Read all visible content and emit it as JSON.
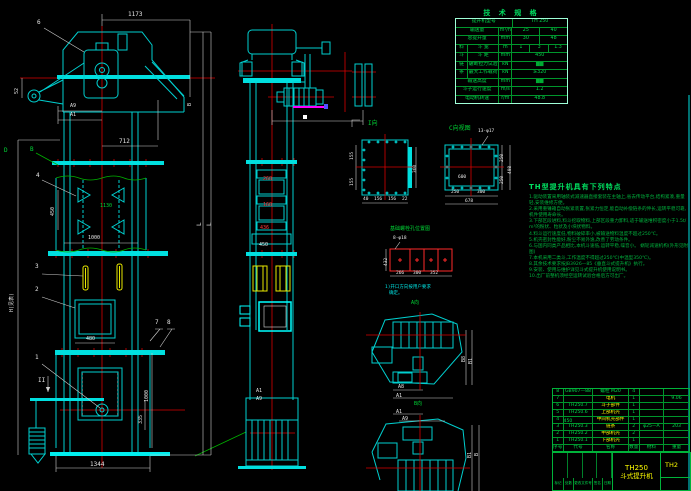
{
  "drawing": {
    "canvas_kind": "CAD model space (bucket elevator assembly drawing)",
    "accent_colors": {
      "geometry": "#00cfcf",
      "dimension": "#e6e6e6",
      "centerline": "#e80000",
      "table": "#00d936",
      "highlight": "#ffff00",
      "flag": "#ff00ff"
    }
  },
  "spec_table": {
    "title": "技 术 规 格",
    "rows": [
      {
        "c": [
          {
            "t": "提升机型号",
            "w": 50
          },
          {
            "t": "TH 250",
            "w": 50
          }
        ]
      },
      {
        "c": [
          {
            "t": "输送量",
            "w": 38
          },
          {
            "t": "m³/h",
            "w": 12
          },
          {
            "t": "25",
            "w": 25
          },
          {
            "t": "40",
            "w": 25
          }
        ]
      },
      {
        "c": [
          {
            "t": "总提升量",
            "w": 38
          },
          {
            "t": "mm",
            "w": 12
          },
          {
            "t": "30",
            "w": 25
          },
          {
            "t": "48",
            "w": 25
          }
        ]
      },
      {
        "c": [
          {
            "t": "料",
            "w": 10
          },
          {
            "t": "斗 宽",
            "w": 28
          },
          {
            "t": "m",
            "w": 12
          },
          {
            "t": "1",
            "w": 16
          },
          {
            "t": "3",
            "w": 17
          },
          {
            "t": "1.3",
            "w": 17
          }
        ]
      },
      {
        "c": [
          {
            "t": "斗",
            "w": 10
          },
          {
            "t": "斗 距",
            "w": 28
          },
          {
            "t": "mm",
            "w": 12
          },
          {
            "t": "450",
            "w": 50
          }
        ]
      },
      {
        "c": [
          {
            "t": "链",
            "w": 10
          },
          {
            "t": "破断拉力试验",
            "w": 28
          },
          {
            "t": "kN",
            "w": 12
          },
          {
            "t": "▇▇",
            "w": 50,
            "cls": "dark"
          }
        ]
      },
      {
        "c": [
          {
            "t": "条",
            "w": 10
          },
          {
            "t": "最大工作载荷",
            "w": 28
          },
          {
            "t": "kN",
            "w": 12
          },
          {
            "t": "≥320",
            "w": 50
          }
        ]
      },
      {
        "c": [
          {
            "t": "输送高度",
            "w": 38
          },
          {
            "t": "mm",
            "w": 12
          },
          {
            "t": "▇▇",
            "w": 50,
            "cls": "dark"
          }
        ]
      },
      {
        "c": [
          {
            "t": "斗子运行速度",
            "w": 38
          },
          {
            "t": "m/s",
            "w": 12
          },
          {
            "t": "1.2",
            "w": 50
          }
        ]
      },
      {
        "c": [
          {
            "t": "电动机转速",
            "w": 38
          },
          {
            "t": "r/m",
            "w": 12
          },
          {
            "t": "48.8",
            "w": 50
          }
        ]
      }
    ]
  },
  "notes": {
    "title": "TH型提升机具有下列特点",
    "lines": [
      "1.驱动装置采用轴装式减速器直接套装在主轴上,省去传动平台,结构紧凑,重量轻,安装维修方便。",
      "2.采用重锤箱自动张紧装置,张紧力恒定,能自动补偿链条的伸长,运转平稳可靠,机件使用寿命长。",
      "3.下部区段进料,料斗挖取物料,上部区段重力卸料,适于输送堆积密度小于1.5t/m³的粉状、粒状及小块状物料。",
      "4.料斗运行速度低,物料破碎率小,被输送物料温度不超过250℃。",
      "5.机壳密封性能好,粉尘不易外逸,改善了劳动条件。",
      "6.与国内同类产品相比,本机斗速低,运转平稳,噪音小。  蜗轮减速机构(外形见附图)",
      "7.本机采用二类斗,工作温度不得超过250℃(中温型350℃)。",
      "8.其余技术要求按JB3926—85《垂直斗式提升机》执行。",
      "9.安装、使用与维护详见斗式提升机使用说明书。",
      "10.出厂前整机须经空运转试验合格后方可出厂。"
    ]
  },
  "bom": {
    "rows": [
      {
        "c": [
          {
            "t": "8",
            "w": 7
          },
          {
            "t": "GB907—88",
            "w": 22
          },
          {
            "t": "螺栓 M20",
            "w": 26
          },
          {
            "t": "4",
            "w": 8
          },
          {
            "t": "",
            "w": 18
          },
          {
            "t": "",
            "w": 19
          }
        ]
      },
      {
        "c": [
          {
            "t": "7",
            "w": 7
          },
          {
            "t": "",
            "w": 22
          },
          {
            "t": "电机",
            "w": 26,
            "cls": "y"
          },
          {
            "t": "1",
            "w": 8
          },
          {
            "t": "",
            "w": 18
          },
          {
            "t": "9.06",
            "w": 19
          }
        ]
      },
      {
        "c": [
          {
            "t": "6",
            "w": 7
          },
          {
            "t": "TH250.7",
            "w": 22
          },
          {
            "t": "斗子部件",
            "w": 26,
            "cls": "y"
          },
          {
            "t": "1",
            "w": 8
          },
          {
            "t": "",
            "w": 18
          },
          {
            "t": "",
            "w": 19
          }
        ]
      },
      {
        "c": [
          {
            "t": "5",
            "w": 7
          },
          {
            "t": "TH250.6",
            "w": 22
          },
          {
            "t": "上部机壳",
            "w": 26,
            "cls": "y"
          },
          {
            "t": "1",
            "w": 8
          },
          {
            "t": "",
            "w": 18
          },
          {
            "t": "",
            "w": 19
          }
        ]
      },
      {
        "c": [
          {
            "t": "4",
            "w": 7
          },
          {
            "t": "TH250.4-450",
            "w": 22
          },
          {
            "t": "中间机壳部件",
            "w": 26,
            "cls": "y"
          },
          {
            "t": "1",
            "w": 8
          },
          {
            "t": "",
            "w": 18
          },
          {
            "t": "",
            "w": 19
          }
        ]
      },
      {
        "c": [
          {
            "t": "3",
            "w": 7
          },
          {
            "t": "TH250.3",
            "w": 22
          },
          {
            "t": "链条",
            "w": 26,
            "cls": "y"
          },
          {
            "t": "2",
            "w": 8
          },
          {
            "t": "φ25—A",
            "w": 18
          },
          {
            "t": "203",
            "w": 19
          }
        ]
      },
      {
        "c": [
          {
            "t": "2",
            "w": 7
          },
          {
            "t": "TH250.2",
            "w": 22
          },
          {
            "t": "中部机壳",
            "w": 26,
            "cls": "y"
          },
          {
            "t": "2",
            "w": 8
          },
          {
            "t": "",
            "w": 18
          },
          {
            "t": "",
            "w": 19
          }
        ]
      },
      {
        "c": [
          {
            "t": "1",
            "w": 7
          },
          {
            "t": "TH250.1",
            "w": 22
          },
          {
            "t": "下部机壳",
            "w": 26,
            "cls": "y"
          },
          {
            "t": "1",
            "w": 8
          },
          {
            "t": "",
            "w": 18
          },
          {
            "t": "",
            "w": 19
          }
        ]
      },
      {
        "c": [
          {
            "t": "序号",
            "w": 7
          },
          {
            "t": "代号",
            "w": 22
          },
          {
            "t": "名称",
            "w": 26
          },
          {
            "t": "数量",
            "w": 8
          },
          {
            "t": "材料",
            "w": 18
          },
          {
            "t": "重量",
            "w": 19
          }
        ]
      }
    ]
  },
  "title_block": {
    "model": "TH250",
    "product": "斗式提升机",
    "drawing_no": "TH2",
    "field_rows": [
      {
        "c": [
          {
            "t": "标记",
            "w": 17
          },
          {
            "t": "处数",
            "w": 17
          },
          {
            "t": "更改文件号",
            "w": 32
          },
          {
            "t": "签名",
            "w": 17
          },
          {
            "t": "日期",
            "w": 17
          }
        ]
      }
    ]
  },
  "labels": [
    {
      "t": "1173",
      "x": 128,
      "y": 12,
      "c": "w",
      "s": 6,
      "n": "dim-1173"
    },
    {
      "t": "712",
      "x": 119,
      "y": 139,
      "c": "w",
      "s": 6,
      "n": "dim-712"
    },
    {
      "t": "A9",
      "x": 70,
      "y": 104,
      "c": "w",
      "s": 5,
      "n": "dim-a9"
    },
    {
      "t": "A1",
      "x": 70,
      "y": 113,
      "c": "w",
      "s": 5,
      "n": "dim-a1"
    },
    {
      "t": "52",
      "x": 15,
      "y": 94,
      "c": "w",
      "r": -90,
      "s": 5,
      "n": "dim-52"
    },
    {
      "t": "B",
      "x": 188,
      "y": 106,
      "c": "w",
      "r": -90,
      "s": 5,
      "n": "dim-b"
    },
    {
      "t": "6",
      "x": 37,
      "y": 20,
      "c": "w",
      "s": 6,
      "n": "balloon-6"
    },
    {
      "t": "4",
      "x": 36,
      "y": 173,
      "c": "w",
      "s": 6,
      "n": "balloon-4"
    },
    {
      "t": "3",
      "x": 35,
      "y": 264,
      "c": "w",
      "s": 6,
      "n": "balloon-3"
    },
    {
      "t": "2",
      "x": 35,
      "y": 287,
      "c": "w",
      "s": 6,
      "n": "balloon-2"
    },
    {
      "t": "1",
      "x": 35,
      "y": 355,
      "c": "w",
      "s": 6,
      "n": "balloon-1"
    },
    {
      "t": "7",
      "x": 155,
      "y": 320,
      "c": "w",
      "s": 6,
      "n": "balloon-7"
    },
    {
      "t": "8",
      "x": 167,
      "y": 320,
      "c": "w",
      "s": 6,
      "n": "balloon-8"
    },
    {
      "t": "II",
      "x": 38,
      "y": 378,
      "c": "w",
      "s": 6,
      "n": "section-mark-ii"
    },
    {
      "t": "B",
      "x": 30,
      "y": 147,
      "c": "g",
      "s": 6,
      "n": "section-letter-b"
    },
    {
      "t": "D",
      "x": 4,
      "y": 148,
      "c": "g",
      "s": 6,
      "n": "section-letter-d"
    },
    {
      "t": "1130",
      "x": 100,
      "y": 204,
      "c": "g",
      "s": 5,
      "n": "dim-1130"
    },
    {
      "t": "450",
      "x": 51,
      "y": 216,
      "c": "w",
      "r": -90,
      "s": 5,
      "n": "dim-450"
    },
    {
      "t": "1000",
      "x": 88,
      "y": 236,
      "c": "w",
      "s": 5,
      "n": "dim-1000"
    },
    {
      "t": "480",
      "x": 86,
      "y": 337,
      "c": "w",
      "s": 5,
      "n": "dim-480"
    },
    {
      "t": "1344",
      "x": 90,
      "y": 462,
      "c": "w",
      "s": 6,
      "n": "dim-1344"
    },
    {
      "t": "1000",
      "x": 145,
      "y": 402,
      "c": "w",
      "r": -90,
      "s": 5,
      "n": "dim-1000-right"
    },
    {
      "t": "335",
      "x": 139,
      "y": 424,
      "c": "w",
      "r": -90,
      "s": 5,
      "n": "dim-335"
    },
    {
      "t": "L",
      "x": 197,
      "y": 226,
      "c": "w",
      "r": -90,
      "s": 6,
      "n": "dim-l1"
    },
    {
      "t": "L",
      "x": 207,
      "y": 226,
      "c": "w",
      "r": -90,
      "s": 6,
      "n": "dim-l2"
    },
    {
      "t": "H(见表)",
      "x": 10,
      "y": 312,
      "c": "w",
      "r": -90,
      "s": 5,
      "n": "dim-h"
    },
    {
      "t": "260",
      "x": 263,
      "y": 177,
      "c": "r",
      "s": 5,
      "n": "dim-260"
    },
    {
      "t": "160",
      "x": 263,
      "y": 203,
      "c": "r",
      "s": 5,
      "n": "dim-160"
    },
    {
      "t": "436",
      "x": 260,
      "y": 226,
      "c": "r",
      "s": 5,
      "n": "dim-436"
    },
    {
      "t": "450",
      "x": 259,
      "y": 243,
      "c": "w",
      "s": 5,
      "n": "dim-450-side"
    },
    {
      "t": "A1",
      "x": 256,
      "y": 389,
      "c": "w",
      "s": 5,
      "n": "dim-a1-side"
    },
    {
      "t": "A9",
      "x": 256,
      "y": 397,
      "c": "w",
      "s": 5,
      "n": "dim-a9-side"
    },
    {
      "t": "I向",
      "x": 368,
      "y": 121,
      "c": "g",
      "s": 6,
      "n": "view-title-i"
    },
    {
      "t": "155",
      "x": 351,
      "y": 160,
      "c": "w",
      "r": -90,
      "s": 4.5,
      "n": "dim-155a"
    },
    {
      "t": "155",
      "x": 351,
      "y": 186,
      "c": "w",
      "r": -90,
      "s": 4.5,
      "n": "dim-155b"
    },
    {
      "t": "360",
      "x": 414,
      "y": 173,
      "c": "w",
      "r": -90,
      "s": 4.5,
      "n": "dim-360"
    },
    {
      "t": "40",
      "x": 363,
      "y": 198,
      "c": "w",
      "s": 4.5,
      "n": "dim-40"
    },
    {
      "t": "156",
      "x": 374,
      "y": 198,
      "c": "w",
      "s": 4.5,
      "n": "dim-156a"
    },
    {
      "t": "156",
      "x": 388,
      "y": 198,
      "c": "w",
      "s": 4.5,
      "n": "dim-156b"
    },
    {
      "t": "22",
      "x": 402,
      "y": 198,
      "c": "w",
      "s": 4.5,
      "n": "dim-22"
    },
    {
      "t": "C向视图",
      "x": 449,
      "y": 126,
      "c": "g",
      "s": 6,
      "n": "view-title-c"
    },
    {
      "t": "13-φ17",
      "x": 478,
      "y": 130,
      "c": "w",
      "s": 4.5,
      "n": "callout-13-holes"
    },
    {
      "t": "600",
      "x": 458,
      "y": 176,
      "c": "w",
      "s": 4.5,
      "n": "dim-600"
    },
    {
      "t": "250",
      "x": 451,
      "y": 191,
      "c": "w",
      "s": 4.5,
      "n": "dim-250a"
    },
    {
      "t": "300",
      "x": 477,
      "y": 191,
      "c": "w",
      "s": 4.5,
      "n": "dim-300a"
    },
    {
      "t": "678",
      "x": 465,
      "y": 200,
      "c": "w",
      "s": 4.5,
      "n": "dim-678"
    },
    {
      "t": "250",
      "x": 501,
      "y": 162,
      "c": "w",
      "r": -90,
      "s": 4.5,
      "n": "dim-250b"
    },
    {
      "t": "250",
      "x": 501,
      "y": 184,
      "c": "w",
      "r": -90,
      "s": 4.5,
      "n": "dim-250c"
    },
    {
      "t": "498",
      "x": 509,
      "y": 174,
      "c": "w",
      "r": -90,
      "s": 4.5,
      "n": "dim-498"
    },
    {
      "t": "基础螺栓孔位置图",
      "x": 390,
      "y": 227,
      "c": "g",
      "s": 5,
      "n": "detail-title-anchor-bolts"
    },
    {
      "t": "8-φ18",
      "x": 393,
      "y": 237,
      "c": "w",
      "s": 4.5,
      "n": "callout-8-holes"
    },
    {
      "t": "432",
      "x": 385,
      "y": 266,
      "c": "w",
      "r": -90,
      "s": 4.5,
      "n": "dim-432"
    },
    {
      "t": "266",
      "x": 396,
      "y": 272,
      "c": "w",
      "s": 4.5,
      "n": "dim-266"
    },
    {
      "t": "300",
      "x": 413,
      "y": 272,
      "c": "w",
      "s": 4.5,
      "n": "dim-300b"
    },
    {
      "t": "352",
      "x": 430,
      "y": 272,
      "c": "w",
      "s": 4.5,
      "n": "dim-352"
    },
    {
      "t": "1)开口方向按用户要求",
      "x": 385,
      "y": 286,
      "c": "c",
      "s": 4.5,
      "n": "note-opening-1"
    },
    {
      "t": "确定。",
      "x": 389,
      "y": 292,
      "c": "c",
      "s": 4.5,
      "n": "note-opening-2"
    },
    {
      "t": "A向",
      "x": 411,
      "y": 301,
      "c": "g",
      "s": 5,
      "n": "view-title-a"
    },
    {
      "t": "A8",
      "x": 398,
      "y": 385,
      "c": "w",
      "s": 5,
      "n": "dim-a8-plan"
    },
    {
      "t": "A1",
      "x": 396,
      "y": 394,
      "c": "w",
      "s": 5,
      "n": "dim-a1-plan"
    },
    {
      "t": "B8",
      "x": 462,
      "y": 362,
      "c": "w",
      "r": -90,
      "s": 5,
      "n": "dim-b8-plan"
    },
    {
      "t": "B1",
      "x": 469,
      "y": 364,
      "c": "w",
      "r": -90,
      "s": 5,
      "n": "dim-b1-plan"
    },
    {
      "t": "B向",
      "x": 414,
      "y": 402,
      "c": "g",
      "s": 5,
      "n": "view-title-b"
    },
    {
      "t": "A1",
      "x": 396,
      "y": 410,
      "c": "w",
      "s": 5,
      "n": "dim-a1-plan2"
    },
    {
      "t": "A9",
      "x": 402,
      "y": 417,
      "c": "w",
      "s": 5,
      "n": "dim-a9-plan2"
    },
    {
      "t": "B1",
      "x": 468,
      "y": 458,
      "c": "w",
      "r": -90,
      "s": 5,
      "n": "dim-b1-plan2"
    },
    {
      "t": "B",
      "x": 475,
      "y": 456,
      "c": "w",
      "r": -90,
      "s": 5,
      "n": "dim-b-plan2"
    }
  ]
}
